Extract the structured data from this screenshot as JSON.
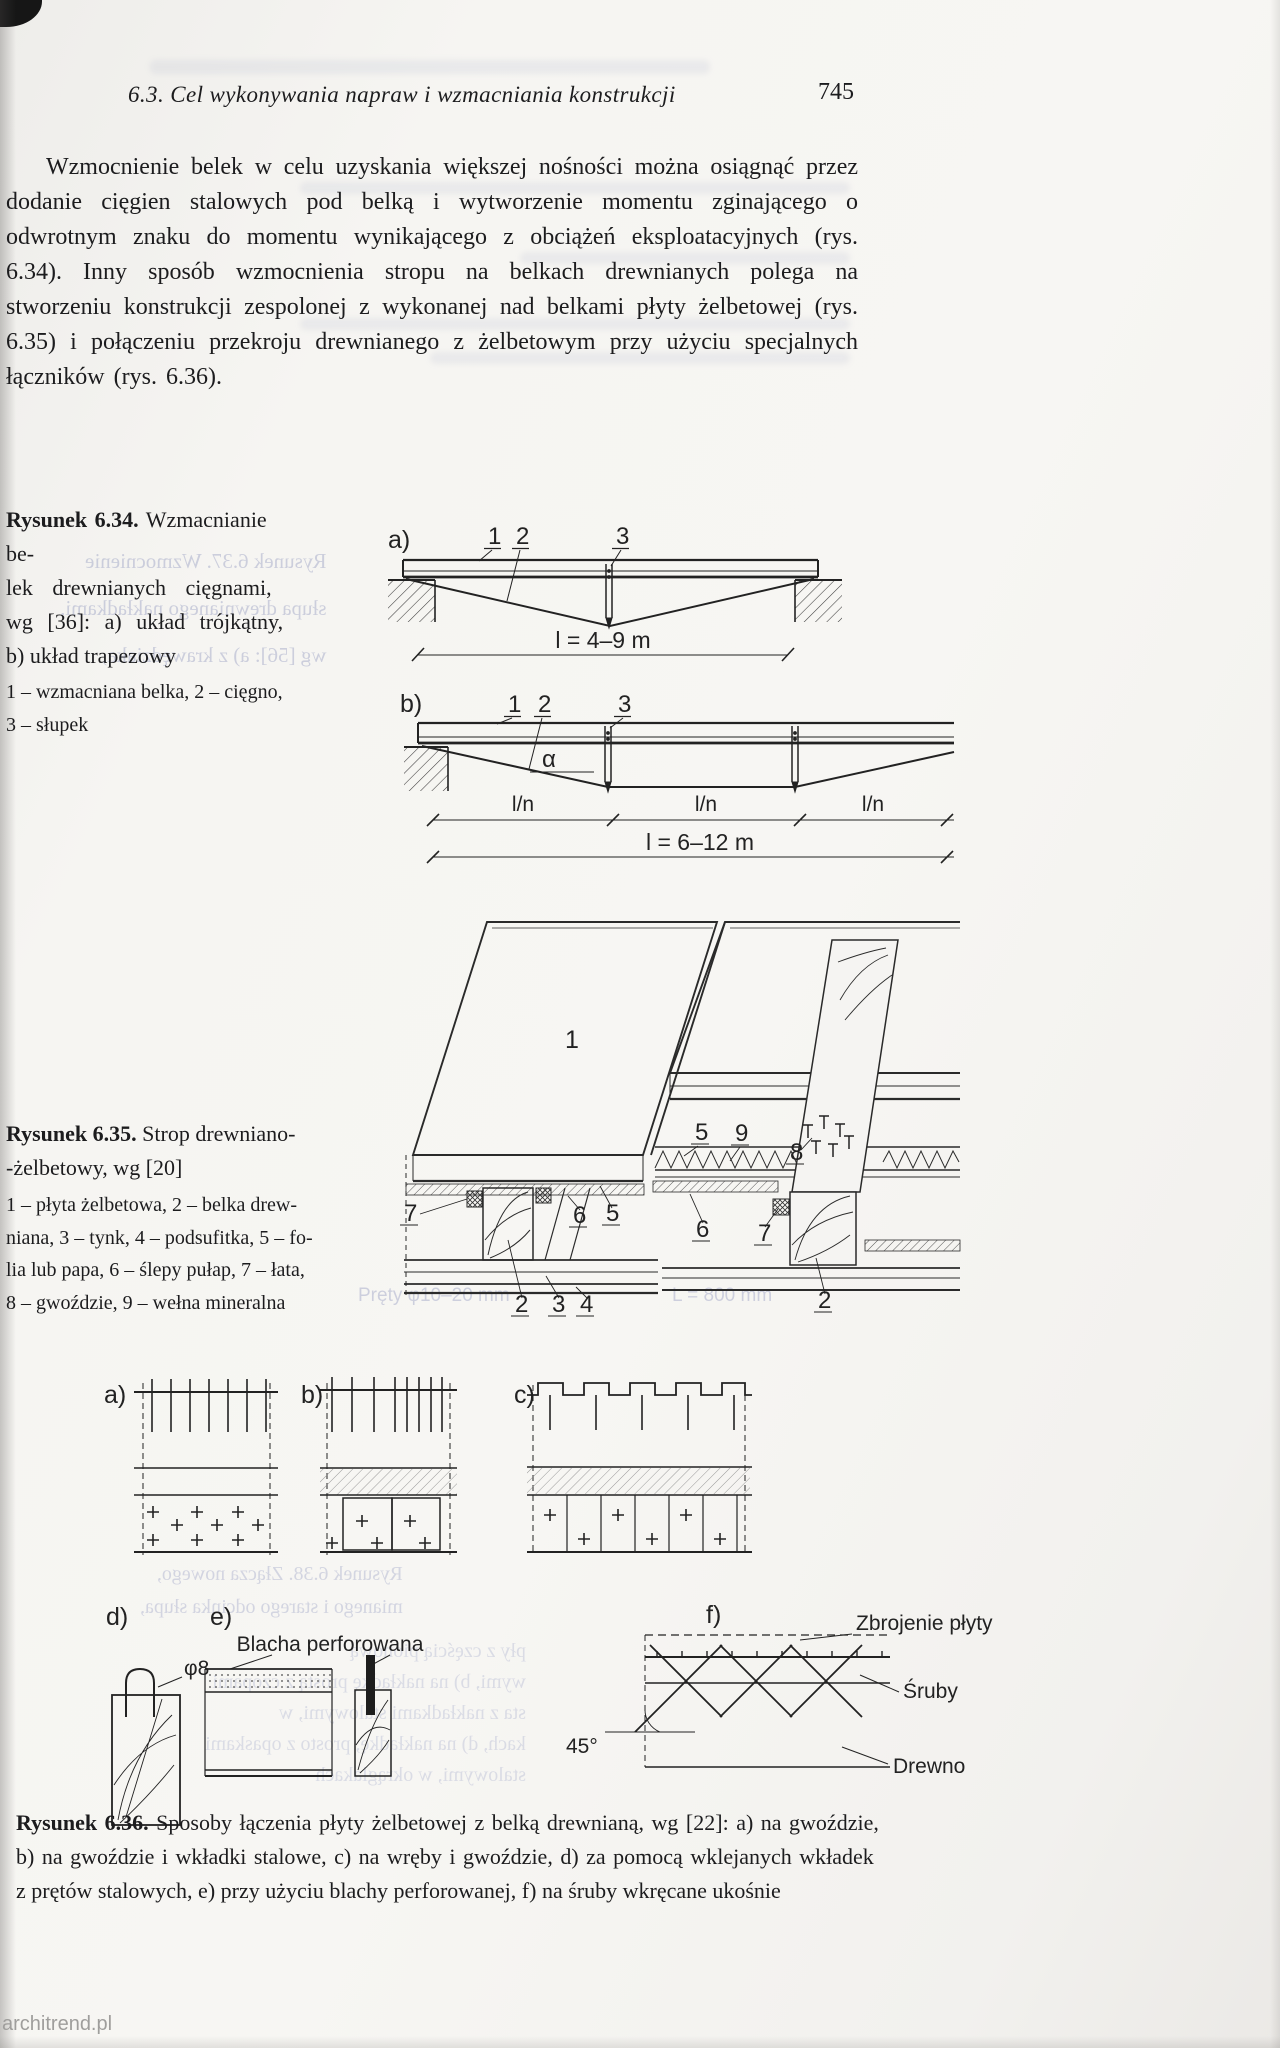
{
  "header": {
    "section_title": "6.3. Cel wykonywania napraw i wzmacniania konstrukcji",
    "page_number": "745"
  },
  "paragraph": "Wzmocnienie belek w celu uzyskania większej nośności można osiągnąć przez dodanie cięgien stalowych pod belką i wytworzenie momentu zginającego o odwrotnym znaku do momentu wynikającego z obciążeń eksploatacyjnych (rys. 6.34). Inny sposób wzmocnienia stropu na belkach drewnianych polega na stworzeniu konstrukcji zespolonej z wykonanej nad belkami płyty żelbetowej (rys. 6.35) i połączeniu przekroju drewnianego z żelbetowym przy użyciu specjalnych łączników (rys. 6.36).",
  "fig_6_34": {
    "caption_title": "Rysunek 6.34.",
    "caption_lines": [
      "Wzmacnianie be-",
      "lek drewnianych cięgnami,",
      "wg [36]: a) układ trójkątny,",
      "b) układ trapezowy"
    ],
    "legend_lines": [
      "1 – wzmacniana belka, 2 – cięgno,",
      "3 – słupek"
    ],
    "a": {
      "label": "a)",
      "n1": "1",
      "n2": "2",
      "n3": "3",
      "dim": "l = 4–9 m"
    },
    "b": {
      "label": "b)",
      "n1": "1",
      "n2": "2",
      "n3": "3",
      "alpha": "α",
      "ln1": "l/n",
      "ln2": "l/n",
      "ln3": "l/n",
      "dim": "l = 6–12 m"
    }
  },
  "fig_6_35": {
    "caption_title": "Rysunek 6.35.",
    "caption_lines": [
      "Strop drewniano-",
      "-żelbetowy, wg [20]"
    ],
    "legend_lines": [
      "1 – płyta żelbetowa, 2 – belka drew-",
      "niana, 3 – tynk, 4 – podsufitka, 5 – fo-",
      "lia lub papa, 6 – ślepy pułap, 7 – łata,",
      "8 – gwoździe, 9 – wełna mineralna"
    ],
    "labels": {
      "slab_left": "1",
      "slab_right": "1",
      "folia_top": "5",
      "welna": "9",
      "gwozdzie": "8",
      "lata_left": "7",
      "pulap_left": "6",
      "folia_left": "5",
      "pulap_right": "6",
      "lata_right": "7",
      "belka_left": "2",
      "tynk": "3",
      "podsufitka": "4",
      "belka_right": "2"
    }
  },
  "fig_6_36": {
    "panel_labels": {
      "a": "a)",
      "b": "b)",
      "c": "c)",
      "d": "d)",
      "e": "e)",
      "f": "f)"
    },
    "annotations": {
      "blacha": "Blacha perforowana",
      "srednica": "φ8",
      "zbrojenie": "Zbrojenie płyty",
      "sruby": "Śruby",
      "angle": "45°",
      "drewno": "Drewno"
    },
    "caption_title": "Rysunek 6.36.",
    "caption_lines": [
      "Sposoby łączenia płyty żelbetowej z belką drewnianą, wg [22]: a) na gwoździe,",
      "b) na gwoździe i wkładki stalowe, c) na wręby i gwoździe, d) za pomocą wklejanych wkładek",
      "z prętów stalowych, e) przy użyciu blachy perforowanej, f) na śruby wkręcane ukośnie"
    ]
  },
  "bleed_through": {
    "fig637_lines": [
      "Rysunek 6.37. Wzmocnienie",
      "słupa drewnianego nakładkami,",
      "wg [56]: a) z krawędziaka,"
    ],
    "fig638_lines": [
      "Rysunek 6.38. Złącza nowego,",
      "mianego i starego odcinka słupa,"
    ],
    "col_lines": [
      "pły z częścią pionową",
      "wymi, b) na nakładkę prostą z czopami",
      "sta z nakładkami stalowymi, w",
      "kach, d) na nakładkę, prosto z opaskami",
      "stalowymi, w okrąglakach"
    ],
    "annot_left": "Pręty φ10–20 mm",
    "annot_right": "L = 800 mm"
  },
  "watermark": "architrend.pl"
}
